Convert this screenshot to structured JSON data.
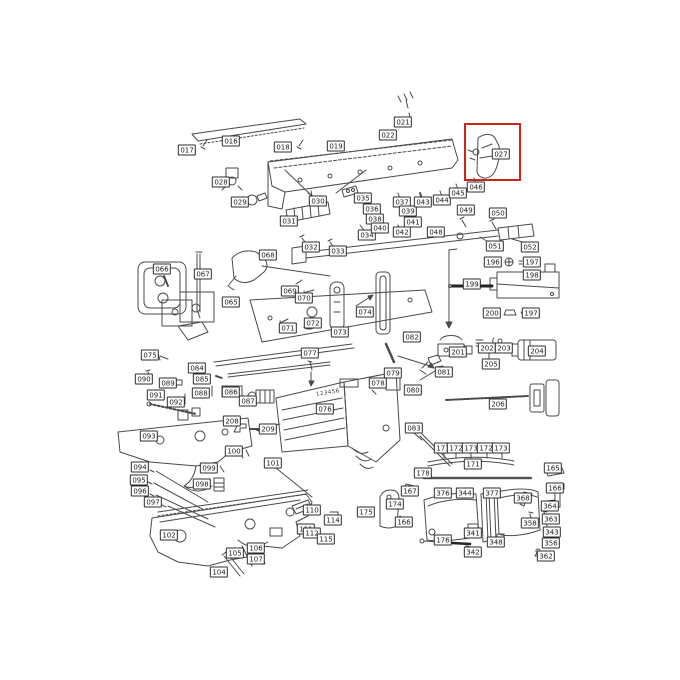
{
  "page": {
    "background": "#ffffff"
  },
  "diagram": {
    "type": "exploded-parts-diagram",
    "subject": "rifle parts schematic",
    "highlight": {
      "part": "027",
      "color": "#c9251d",
      "x": 464,
      "y": 123,
      "w": 53,
      "h": 54
    },
    "stock_marking": "123456",
    "labels": [
      {
        "t": "016",
        "x": 231,
        "y": 141
      },
      {
        "t": "017",
        "x": 187,
        "y": 150
      },
      {
        "t": "018",
        "x": 283,
        "y": 147
      },
      {
        "t": "019",
        "x": 336,
        "y": 146
      },
      {
        "t": "021",
        "x": 403,
        "y": 122
      },
      {
        "t": "022",
        "x": 388,
        "y": 135
      },
      {
        "t": "027",
        "x": 501,
        "y": 154
      },
      {
        "t": "028",
        "x": 221,
        "y": 182
      },
      {
        "t": "029",
        "x": 240,
        "y": 202
      },
      {
        "t": "030",
        "x": 318,
        "y": 201
      },
      {
        "t": "031",
        "x": 289,
        "y": 221
      },
      {
        "t": "032",
        "x": 311,
        "y": 247
      },
      {
        "t": "033",
        "x": 338,
        "y": 251
      },
      {
        "t": "034",
        "x": 367,
        "y": 235
      },
      {
        "t": "035",
        "x": 363,
        "y": 198
      },
      {
        "t": "036",
        "x": 372,
        "y": 209
      },
      {
        "t": "037",
        "x": 402,
        "y": 202
      },
      {
        "t": "038",
        "x": 375,
        "y": 219
      },
      {
        "t": "039",
        "x": 408,
        "y": 211
      },
      {
        "t": "040",
        "x": 380,
        "y": 228
      },
      {
        "t": "041",
        "x": 413,
        "y": 222
      },
      {
        "t": "042",
        "x": 402,
        "y": 232
      },
      {
        "t": "043",
        "x": 423,
        "y": 202
      },
      {
        "t": "044",
        "x": 442,
        "y": 200
      },
      {
        "t": "045",
        "x": 458,
        "y": 193
      },
      {
        "t": "046",
        "x": 476,
        "y": 187
      },
      {
        "t": "048",
        "x": 436,
        "y": 232
      },
      {
        "t": "049",
        "x": 466,
        "y": 210
      },
      {
        "t": "050",
        "x": 498,
        "y": 213
      },
      {
        "t": "051",
        "x": 495,
        "y": 246
      },
      {
        "t": "052",
        "x": 530,
        "y": 247
      },
      {
        "t": "196",
        "x": 493,
        "y": 262
      },
      {
        "t": "197",
        "x": 532,
        "y": 262
      },
      {
        "t": "198",
        "x": 532,
        "y": 275
      },
      {
        "t": "199",
        "x": 472,
        "y": 284
      },
      {
        "t": "200",
        "x": 492,
        "y": 313
      },
      {
        "t": "197",
        "x": 531,
        "y": 313
      },
      {
        "t": "201",
        "x": 458,
        "y": 352
      },
      {
        "t": "202",
        "x": 487,
        "y": 348
      },
      {
        "t": "203",
        "x": 504,
        "y": 348
      },
      {
        "t": "204",
        "x": 537,
        "y": 351
      },
      {
        "t": "205",
        "x": 491,
        "y": 364
      },
      {
        "t": "206",
        "x": 498,
        "y": 404
      },
      {
        "t": "065",
        "x": 231,
        "y": 302
      },
      {
        "t": "066",
        "x": 162,
        "y": 269
      },
      {
        "t": "067",
        "x": 203,
        "y": 274
      },
      {
        "t": "068",
        "x": 268,
        "y": 255
      },
      {
        "t": "069",
        "x": 290,
        "y": 291
      },
      {
        "t": "070",
        "x": 304,
        "y": 298
      },
      {
        "t": "071",
        "x": 288,
        "y": 328
      },
      {
        "t": "072",
        "x": 313,
        "y": 323
      },
      {
        "t": "073",
        "x": 340,
        "y": 332
      },
      {
        "t": "074",
        "x": 365,
        "y": 312
      },
      {
        "t": "075",
        "x": 150,
        "y": 355
      },
      {
        "t": "076",
        "x": 325,
        "y": 409
      },
      {
        "t": "077",
        "x": 310,
        "y": 353
      },
      {
        "t": "078",
        "x": 378,
        "y": 383
      },
      {
        "t": "079",
        "x": 393,
        "y": 373
      },
      {
        "t": "080",
        "x": 413,
        "y": 390
      },
      {
        "t": "081",
        "x": 444,
        "y": 372
      },
      {
        "t": "082",
        "x": 412,
        "y": 337
      },
      {
        "t": "083",
        "x": 414,
        "y": 428
      },
      {
        "t": "084",
        "x": 197,
        "y": 368
      },
      {
        "t": "085",
        "x": 202,
        "y": 379
      },
      {
        "t": "086",
        "x": 231,
        "y": 392
      },
      {
        "t": "087",
        "x": 248,
        "y": 401
      },
      {
        "t": "088",
        "x": 201,
        "y": 393
      },
      {
        "t": "089",
        "x": 168,
        "y": 383
      },
      {
        "t": "090",
        "x": 144,
        "y": 379
      },
      {
        "t": "091",
        "x": 156,
        "y": 395
      },
      {
        "t": "092",
        "x": 176,
        "y": 402
      },
      {
        "t": "093",
        "x": 149,
        "y": 436
      },
      {
        "t": "208",
        "x": 232,
        "y": 421
      },
      {
        "t": "209",
        "x": 268,
        "y": 429
      },
      {
        "t": "094",
        "x": 140,
        "y": 467
      },
      {
        "t": "095",
        "x": 139,
        "y": 480
      },
      {
        "t": "096",
        "x": 140,
        "y": 491
      },
      {
        "t": "097",
        "x": 153,
        "y": 502
      },
      {
        "t": "098",
        "x": 202,
        "y": 484
      },
      {
        "t": "099",
        "x": 209,
        "y": 468
      },
      {
        "t": "100",
        "x": 234,
        "y": 451
      },
      {
        "t": "101",
        "x": 273,
        "y": 463
      },
      {
        "t": "102",
        "x": 169,
        "y": 535
      },
      {
        "t": "104",
        "x": 219,
        "y": 572
      },
      {
        "t": "105",
        "x": 235,
        "y": 553
      },
      {
        "t": "106",
        "x": 256,
        "y": 548
      },
      {
        "t": "107",
        "x": 256,
        "y": 559
      },
      {
        "t": "110",
        "x": 312,
        "y": 510
      },
      {
        "t": "111",
        "x": 306,
        "y": 529
      },
      {
        "t": "112",
        "x": 312,
        "y": 533
      },
      {
        "t": "114",
        "x": 333,
        "y": 520
      },
      {
        "t": "115",
        "x": 326,
        "y": 539
      },
      {
        "t": "167",
        "x": 410,
        "y": 491
      },
      {
        "t": "174",
        "x": 395,
        "y": 504
      },
      {
        "t": "175",
        "x": 366,
        "y": 512
      },
      {
        "t": "166",
        "x": 404,
        "y": 522
      },
      {
        "t": "173",
        "x": 443,
        "y": 448
      },
      {
        "t": "172",
        "x": 456,
        "y": 448
      },
      {
        "t": "173",
        "x": 471,
        "y": 448
      },
      {
        "t": "172",
        "x": 486,
        "y": 448
      },
      {
        "t": "173",
        "x": 501,
        "y": 448
      },
      {
        "t": "171",
        "x": 473,
        "y": 464
      },
      {
        "t": "178",
        "x": 423,
        "y": 473
      },
      {
        "t": "376",
        "x": 443,
        "y": 493
      },
      {
        "t": "344",
        "x": 465,
        "y": 493
      },
      {
        "t": "377",
        "x": 492,
        "y": 493
      },
      {
        "t": "368",
        "x": 523,
        "y": 498
      },
      {
        "t": "165",
        "x": 553,
        "y": 468
      },
      {
        "t": "166",
        "x": 555,
        "y": 488
      },
      {
        "t": "364",
        "x": 550,
        "y": 506
      },
      {
        "t": "363",
        "x": 551,
        "y": 519
      },
      {
        "t": "358",
        "x": 530,
        "y": 523
      },
      {
        "t": "343",
        "x": 552,
        "y": 532
      },
      {
        "t": "356",
        "x": 551,
        "y": 543
      },
      {
        "t": "362",
        "x": 546,
        "y": 556
      },
      {
        "t": "341",
        "x": 473,
        "y": 533
      },
      {
        "t": "342",
        "x": 473,
        "y": 552
      },
      {
        "t": "176",
        "x": 443,
        "y": 540
      },
      {
        "t": "348",
        "x": 496,
        "y": 542
      }
    ]
  }
}
